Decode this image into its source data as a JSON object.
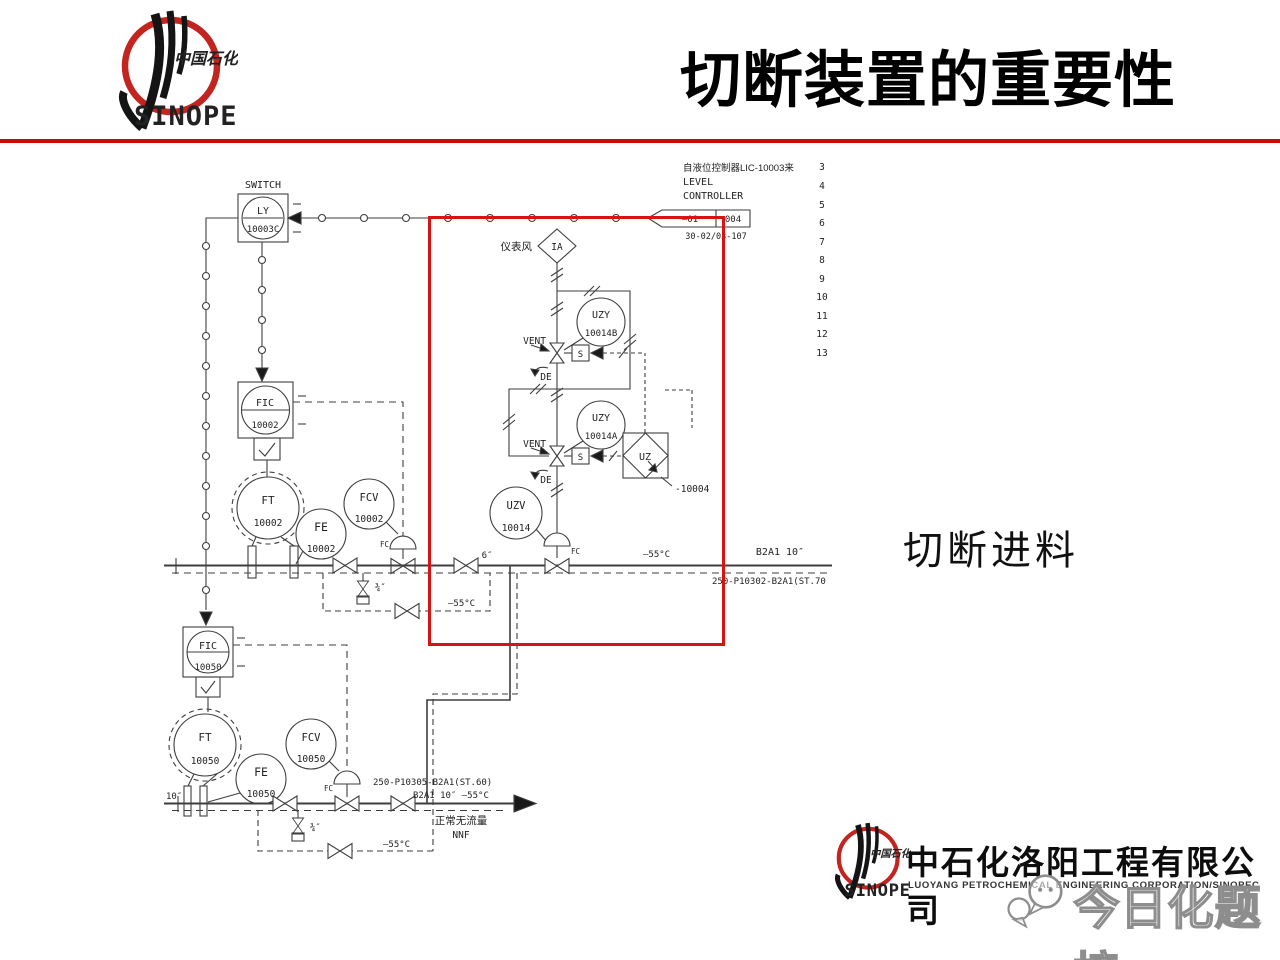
{
  "header": {
    "title": "切断装置的重要性"
  },
  "logo": {
    "cn": "中国石化",
    "en": "SINOPEC"
  },
  "annotation": {
    "label": "切断进料"
  },
  "watermark": {
    "text": "今日化题榜"
  },
  "footer": {
    "logo_cn": "中国石化",
    "logo_en": "SINOPEC",
    "cn_name": "中石化洛阳工程有限公司",
    "en_name": "LUOYANG PETROCHEMICAL ENGINEERING CORPORATION/SINOPEC"
  },
  "colors": {
    "accent_red": "#cc0a0a",
    "highlight_red": "#d61414",
    "line": "#3e3e3e"
  },
  "diagram": {
    "rows": [
      "3",
      "4",
      "5",
      "6",
      "7",
      "8",
      "9",
      "10",
      "11",
      "12",
      "13"
    ],
    "top": {
      "switch_label": "SWITCH",
      "ly": "LY",
      "ly_num": "10003C",
      "from_line": "自液位控制器LIC-10003来",
      "level": "LEVEL",
      "controller": "CONTROLLER",
      "pennant_a": "—01",
      "pennant_b": "004",
      "pennant_ref": "30-02/03-107"
    },
    "air": {
      "cn": "仪表风",
      "tag": "IA"
    },
    "trip": {
      "uzy_b": "UZY",
      "uzy_b_num": "10014B",
      "vent1": "VENT",
      "de1": "DE",
      "s1": "S",
      "uzy_a": "UZY",
      "uzy_a_num": "10014A",
      "vent2": "VENT",
      "de2": "DE",
      "s2": "S",
      "uz": "UZ",
      "uz_num": "-10004",
      "uzv": "UZV",
      "uzv_num": "10014",
      "fc_uzv": "FC"
    },
    "loop1": {
      "fic": "FIC",
      "fic_num": "10002",
      "ft": "FT",
      "ft_num": "10002",
      "fe": "FE",
      "fe_num": "10002",
      "fcv": "FCV",
      "fcv_num": "10002",
      "fc": "FC"
    },
    "loop2": {
      "fic": "FIC",
      "fic_num": "10050",
      "ft": "FT",
      "ft_num": "10050",
      "fe": "FE",
      "fe_num": "10050",
      "fcv": "FCV",
      "fcv_num": "10050",
      "fc": "FC"
    },
    "pipes": {
      "size6": "6″",
      "temp_mid": "—55°C",
      "class_top": "B2A1  10″",
      "line_top": "250-P10302-B2A1(ST.70",
      "bp1_size": "¾″",
      "bp1_temp": "—55°C",
      "size10": "10″",
      "line_bottom": "250-P10305-B2A1(ST.60)",
      "class_bottom": "B2A1  10″ —55°C",
      "nnf_cn": "正常无流量",
      "nnf": "NNF",
      "bp2_temp": "—55°C",
      "bp2_size": "¾″"
    }
  }
}
